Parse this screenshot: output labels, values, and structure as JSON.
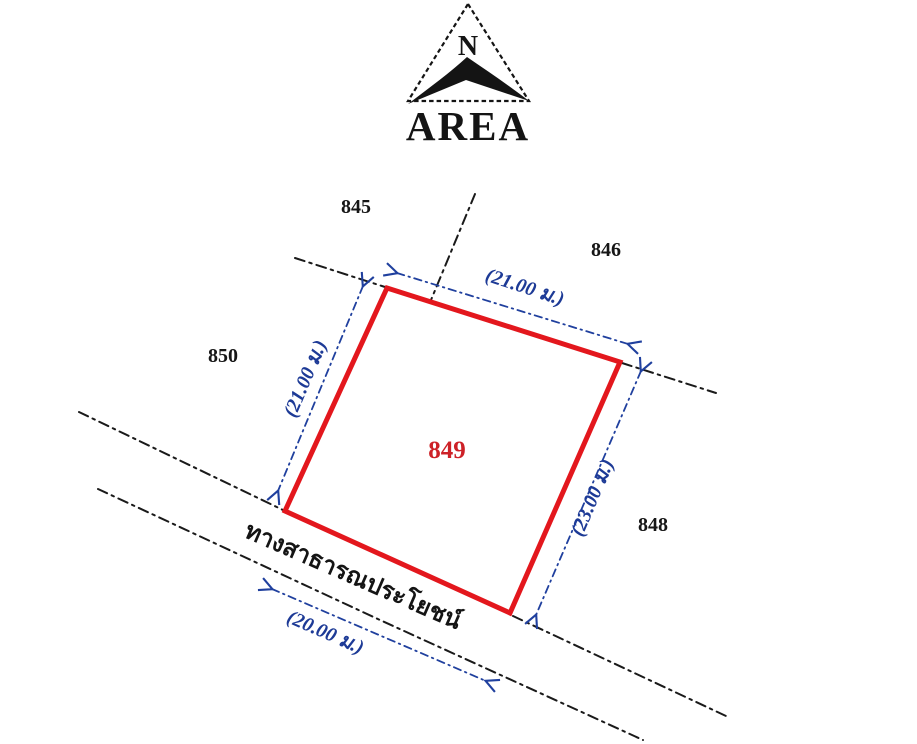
{
  "compass": {
    "north_label": "N",
    "brand_label": "AREA"
  },
  "parcels": {
    "main": {
      "id": "849"
    },
    "neighbor_top_left": {
      "id": "845"
    },
    "neighbor_top_right": {
      "id": "846"
    },
    "neighbor_left": {
      "id": "850"
    },
    "neighbor_right": {
      "id": "848"
    }
  },
  "dimensions": {
    "top_edge": "(21.00 ม.)",
    "left_edge": "(21.00 ม.)",
    "right_edge": "(23.00 ม.)",
    "road_width": "(20.00 ม.)"
  },
  "road": {
    "name": "ทางสาธารณประโยชน์"
  },
  "colors": {
    "parcel_outline_red": "#e3171d",
    "parcel_id_red": "#cd2127",
    "dimension_blue": "#20409e",
    "ink_black": "#1a1a1a"
  }
}
